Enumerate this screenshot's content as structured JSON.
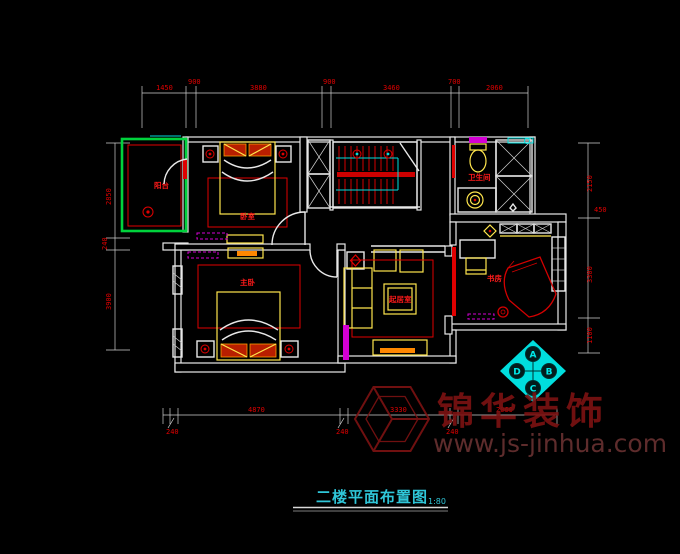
{
  "title": {
    "text": "二楼平面布置图",
    "scale": "1:80"
  },
  "watermark": {
    "brand": "锦华装饰",
    "url": "www.js-jinhua.com"
  },
  "compass": {
    "top": "A",
    "right": "B",
    "bottom": "C",
    "left": "D"
  },
  "rooms": {
    "balcony": "阳台",
    "bedroom": "卧室",
    "bathroom": "卫生间",
    "study": "书房",
    "master_bedroom": "主卧",
    "living_room": "起居室"
  },
  "dimensions": {
    "top": [
      "1450",
      "900",
      "3880",
      "900",
      "3460",
      "700",
      "2060"
    ],
    "left": [
      "2850",
      "240",
      "3900"
    ],
    "right": [
      "2150",
      "450",
      "3300",
      "1100"
    ],
    "bottom": [
      "240",
      "4870",
      "240",
      "3330",
      "240",
      "2060"
    ]
  },
  "colors": {
    "wall": "#e8e8e8",
    "dimension_red": "#e00000",
    "furniture_yellow": "#ffe64d",
    "balcony_green": "#00d23c",
    "cad_cyan": "#00dede",
    "wardrobe_magenta": "#d400d4",
    "watermark_red": "#7d1212"
  }
}
